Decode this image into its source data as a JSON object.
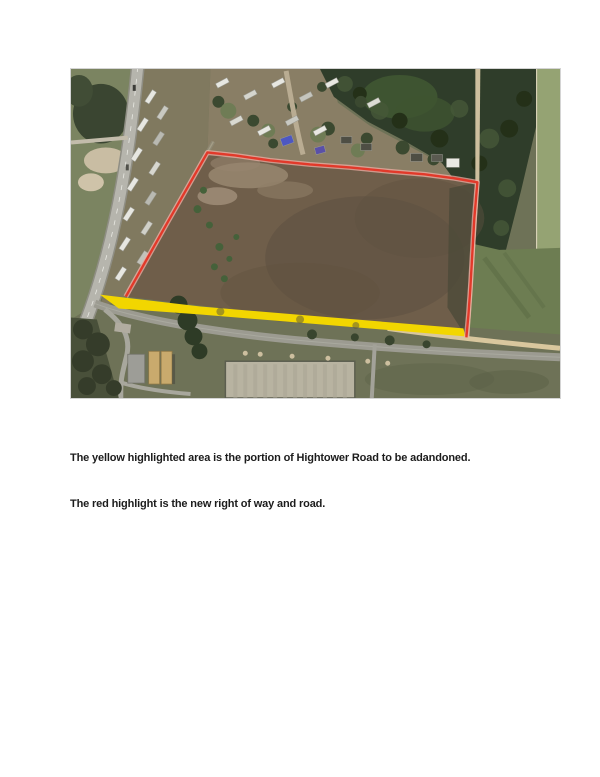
{
  "figure": {
    "alt": "Aerial satellite photograph of a parcel along Hightower Road with highlighted road annotations"
  },
  "annotations": {
    "abandoned_road": {
      "color": "#f2d600",
      "meaning": "yellow highlighted area - portion of Hightower Road to be abandoned"
    },
    "new_right_of_way": {
      "color": "#e2392a",
      "halo_color": "#f7b0a6",
      "meaning": "red highlight - new right of way and road"
    }
  },
  "captions": [
    "The yellow highlighted area is the portion of Hightower Road to be adandoned.",
    "The red highlight is the new right of way and road."
  ]
}
